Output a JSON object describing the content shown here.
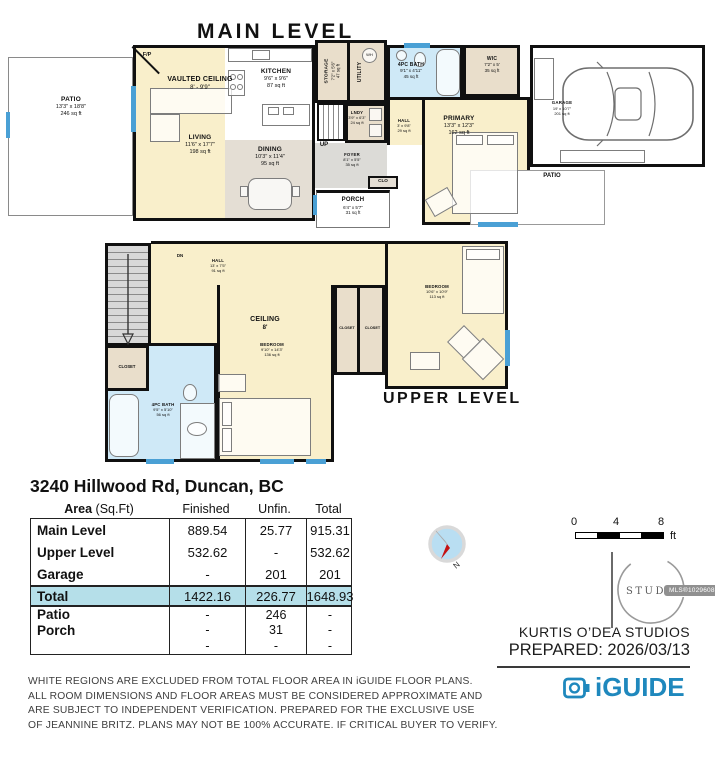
{
  "titles": {
    "main": "MAIN LEVEL",
    "upper": "UPPER LEVEL"
  },
  "meta": {
    "address": "3240 Hillwood Rd, Duncan, BC",
    "studio": "KURTIS O’DEA STUDIOS",
    "prepared": "PREPARED: 2026/03/13",
    "mls": "MLS®1029608"
  },
  "main_level": {
    "rooms": {
      "patio": {
        "name": "PATIO",
        "dims": "13'3\" x 18'8\"",
        "area": "246 sq ft"
      },
      "vaulted": {
        "name": "VAULTED CEILING",
        "dims": "8' - 9'9\""
      },
      "living": {
        "name": "LIVING",
        "dims": "11'6\" x 17'7\"",
        "area": "198 sq ft"
      },
      "kitchen": {
        "name": "KITCHEN",
        "dims": "9'6\" x 9'6\"",
        "area": "87 sq ft"
      },
      "dining": {
        "name": "DINING",
        "dims": "10'3\" x 11'4\"",
        "area": "95 sq ft"
      },
      "storage": {
        "name": "STORAGE",
        "dims": "7'2\" x 5'6\"",
        "area": "47 sq ft"
      },
      "utility": {
        "name": "UTILITY"
      },
      "lndy": {
        "name": "LNDY",
        "dims": "3'9\" x 6'3\"",
        "area": "24 sq ft"
      },
      "bath": {
        "name": "4PC BATH",
        "dims": "9'1\" x 4'11\"",
        "area": "45 sq ft"
      },
      "wic": {
        "name": "WIC",
        "dims": "7'2\" x 5'",
        "area": "35 sq ft"
      },
      "hall": {
        "name": "HALL",
        "dims": "3' x 9'8\"",
        "area": "29 sq ft"
      },
      "primary": {
        "name": "PRIMARY",
        "dims": "13'3\" x 12'3\"",
        "area": "162 sq ft"
      },
      "garage": {
        "name": "GARAGE",
        "dims": "19' x 10'7\"",
        "area": "201 sq ft"
      },
      "foyer": {
        "name": "FOYER",
        "dims": "8'1\" x 5'5\"",
        "area": "35 sq ft"
      },
      "porch": {
        "name": "PORCH",
        "dims": "6'4\" x 5'7\"",
        "area": "31 sq ft"
      },
      "patio_right": {
        "name": "PATIO"
      }
    },
    "labels": {
      "fp": "F/P",
      "up": "UP",
      "clo": "CLO",
      "wh": "WH"
    }
  },
  "upper_level": {
    "rooms": {
      "hall": {
        "name": "HALL",
        "dims": "13' x 7'5\"",
        "area": "91 sq ft"
      },
      "ceiling": {
        "name": "CEILING",
        "dims": "8'"
      },
      "bedroom_left": {
        "name": "BEDROOM",
        "dims": "9'10\" x 14'3\"",
        "area": "136 sq ft"
      },
      "bedroom_right": {
        "name": "BEDROOM",
        "dims": "10'6\" x 10'9\"",
        "area": "113 sq ft"
      },
      "bath": {
        "name": "4PC BATH",
        "dims": "9'5\" x 5'10\"",
        "area": "56 sq ft"
      }
    },
    "labels": {
      "dn": "DN",
      "closet": "CLOSET"
    }
  },
  "table": {
    "header": {
      "area": "Area",
      "area_unit": " (Sq.Ft)",
      "finished": "Finished",
      "unfin": "Unfin.",
      "total": "Total"
    },
    "rows": [
      {
        "label": "Main Level",
        "finished": "889.54",
        "unfin": "25.77",
        "total": "915.31"
      },
      {
        "label": "Upper Level",
        "finished": "532.62",
        "unfin": "-",
        "total": "532.62"
      },
      {
        "label": "Garage",
        "finished": "-",
        "unfin": "201",
        "total": "201"
      }
    ],
    "total_row": {
      "label": "Total",
      "finished": "1422.16",
      "unfin": "226.77",
      "total": "1648.93"
    },
    "extra_rows": [
      {
        "label": "Patio",
        "finished": "-",
        "unfin": "246",
        "total": "-"
      },
      {
        "label": "Porch",
        "finished": "-",
        "unfin": "31",
        "total": "-"
      },
      {
        "label": "",
        "finished": "-",
        "unfin": "-",
        "total": "-"
      }
    ]
  },
  "scale_bar": {
    "t0": "0",
    "t1": "4",
    "t2": "8",
    "unit": "ft"
  },
  "compass": {
    "n": "N"
  },
  "logos": {
    "studios": "STUDIOS",
    "iguide": "iGUIDE"
  },
  "disclaimer": [
    "WHITE REGIONS ARE EXCLUDED FROM TOTAL FLOOR AREA IN iGUIDE FLOOR PLANS.",
    "ALL ROOM DIMENSIONS AND FLOOR AREAS MUST BE CONSIDERED APPROXIMATE AND",
    "ARE SUBJECT TO INDEPENDENT VERIFICATION. PREPARED FOR THE EXCLUSIVE USE",
    "OF JEANNINE BRITZ. PLANS MAY NOT BE 100% ACCURATE. IF CRITICAL BUYER TO VERIFY."
  ],
  "colors": {
    "accent_blue": "#1f88bd",
    "window_blue": "#4aa0d5",
    "bath_blue": "#cfe9f7",
    "room_cream": "#f9efcb",
    "highlight_row": "#b5dfe9"
  }
}
